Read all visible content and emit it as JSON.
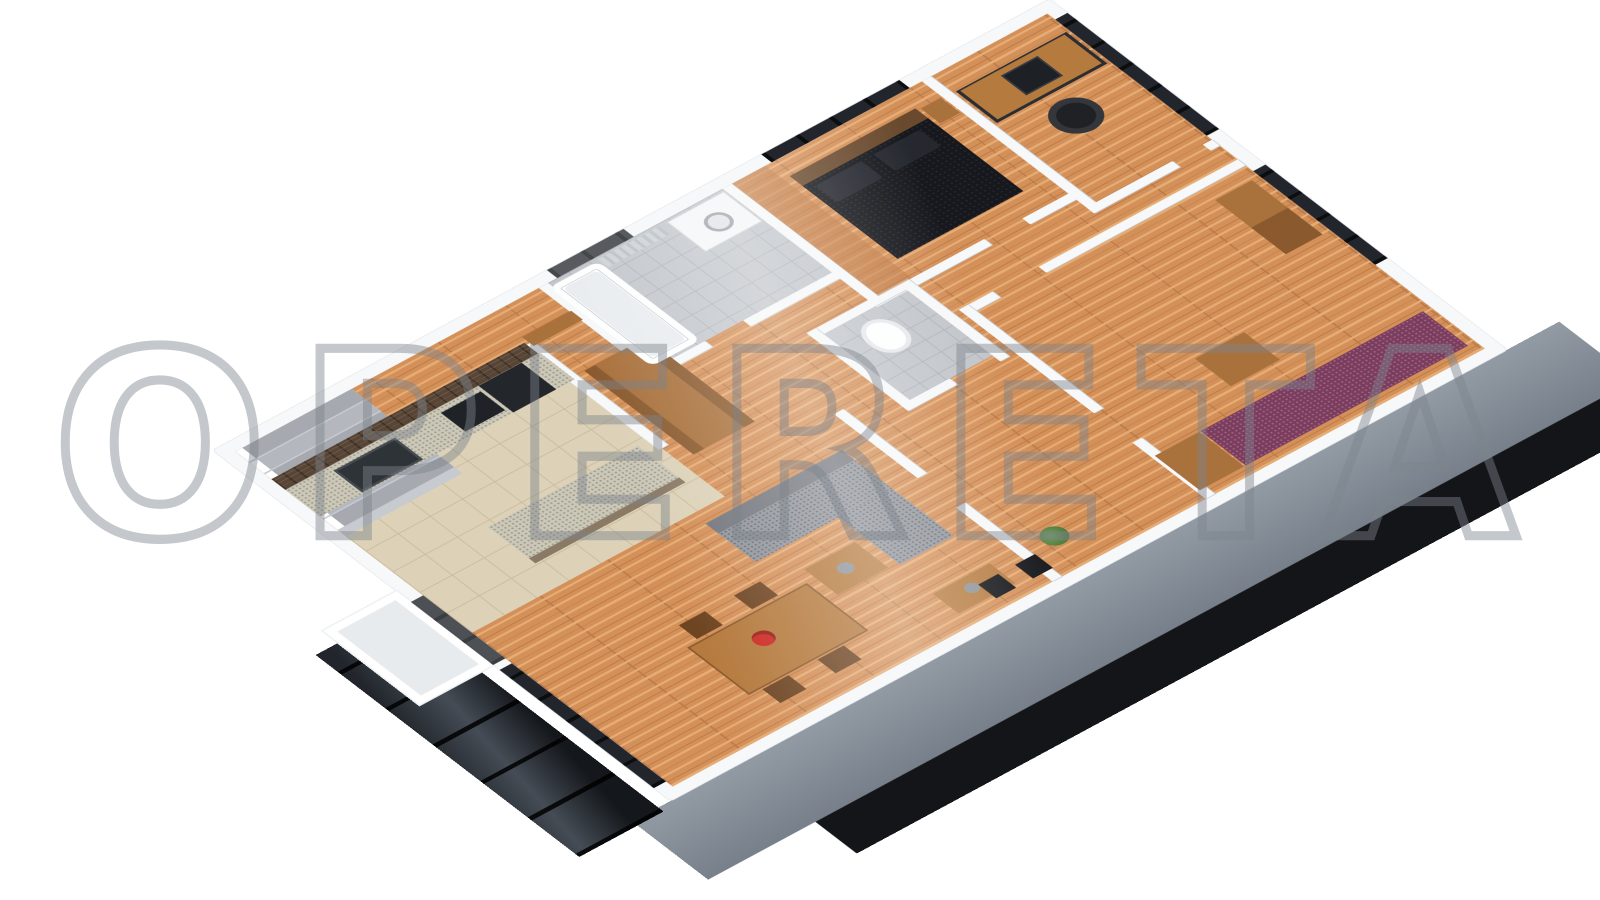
{
  "watermark": {
    "text": "OPERETA"
  },
  "scene": {
    "type": "isometric-3d-floorplan-render",
    "background": "#ffffff",
    "rooms": [
      "stairs",
      "kitchen",
      "living-room",
      "dining-area",
      "hallway",
      "bathroom",
      "wc",
      "master-bedroom",
      "office",
      "second-bedroom",
      "terrace"
    ],
    "furniture": [
      "kitchen-counter",
      "sink",
      "stove",
      "fridge",
      "kitchen-island",
      "wardrobe",
      "bathtub",
      "washing-machine",
      "radiator",
      "toilet",
      "double-bed",
      "pillows",
      "nightstand",
      "desk",
      "laptop",
      "office-chair",
      "purple-bed",
      "bench",
      "dresser",
      "sectional-sofa",
      "coffee-table",
      "console-table",
      "dining-table",
      "dining-chairs",
      "flower-vase",
      "speakers",
      "plant"
    ]
  },
  "palette": {
    "wood": "#d49059",
    "wood_dark": "#bd7943",
    "wood_light": "#e6ac74",
    "tile": "#ddd2b8",
    "tile_line": "#c9bb9c",
    "bath_tile": "#c2c6cb",
    "bath_tile_line": "#aeb3b9",
    "brick": "#584535",
    "wall": "#f6f8f9",
    "wall_line": "#c9ced3",
    "facade": "#929ba4",
    "facade_dark": "#77808a",
    "plinth": "#141518",
    "glass": "#22262c",
    "glass_light": "#454c55",
    "bed": "#16181d",
    "headboard": "#6a4a2e",
    "sofa": "#8f939a",
    "sofa_dark": "#72757c",
    "purple": "#7b3c5e",
    "granite": "#ccc8b8",
    "cabinet": "#a9713c",
    "desk": "#b57a3e",
    "steps": "#b4b8be",
    "red": "#cc2a22",
    "green": "#4d7a3c",
    "watermark_gray": "#7e848c"
  }
}
